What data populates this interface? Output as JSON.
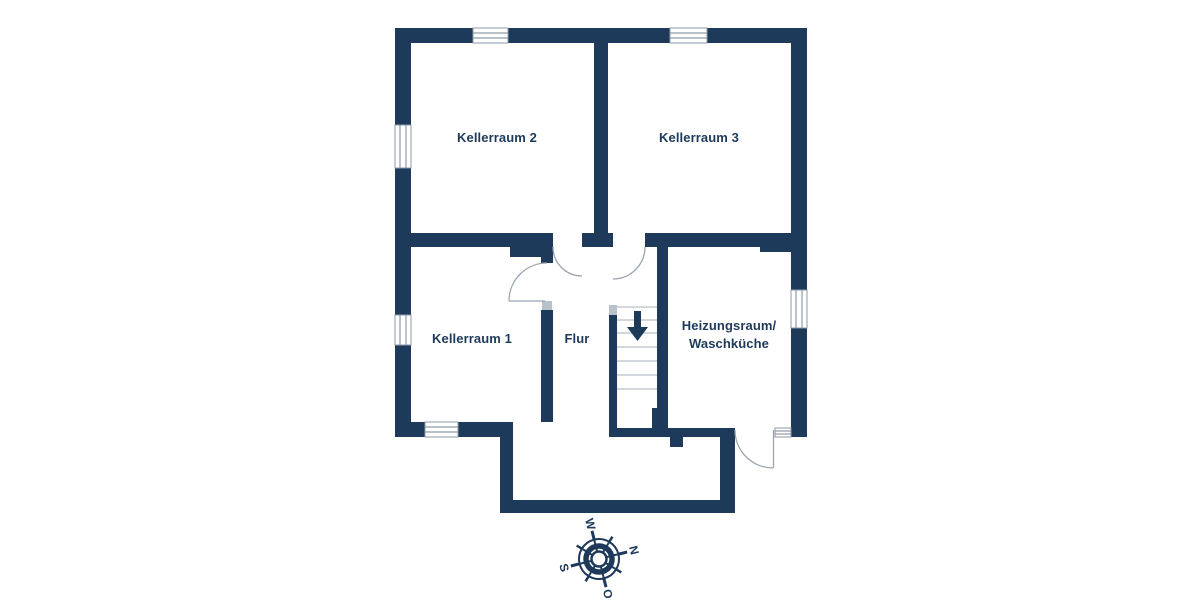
{
  "rooms": {
    "kellerraum2": {
      "label": "Kellerraum 2"
    },
    "kellerraum3": {
      "label": "Kellerraum 3"
    },
    "kellerraum1": {
      "label": "Kellerraum 1"
    },
    "flur": {
      "label": "Flur"
    },
    "heizungsraum": {
      "label_line1": "Heizungsraum/",
      "label_line2": "Waschküche"
    }
  },
  "compass": {
    "north": "N",
    "east": "O",
    "south": "S",
    "west": "W"
  },
  "colors": {
    "wall": "#1e3a5b",
    "background": "#ffffff",
    "text": "#1e3a5b",
    "door_arc": "#9aa5b0",
    "window_line": "#8e9aa8",
    "stair_tread": "#c5cbd2",
    "jamb": "#b9c2cb"
  }
}
